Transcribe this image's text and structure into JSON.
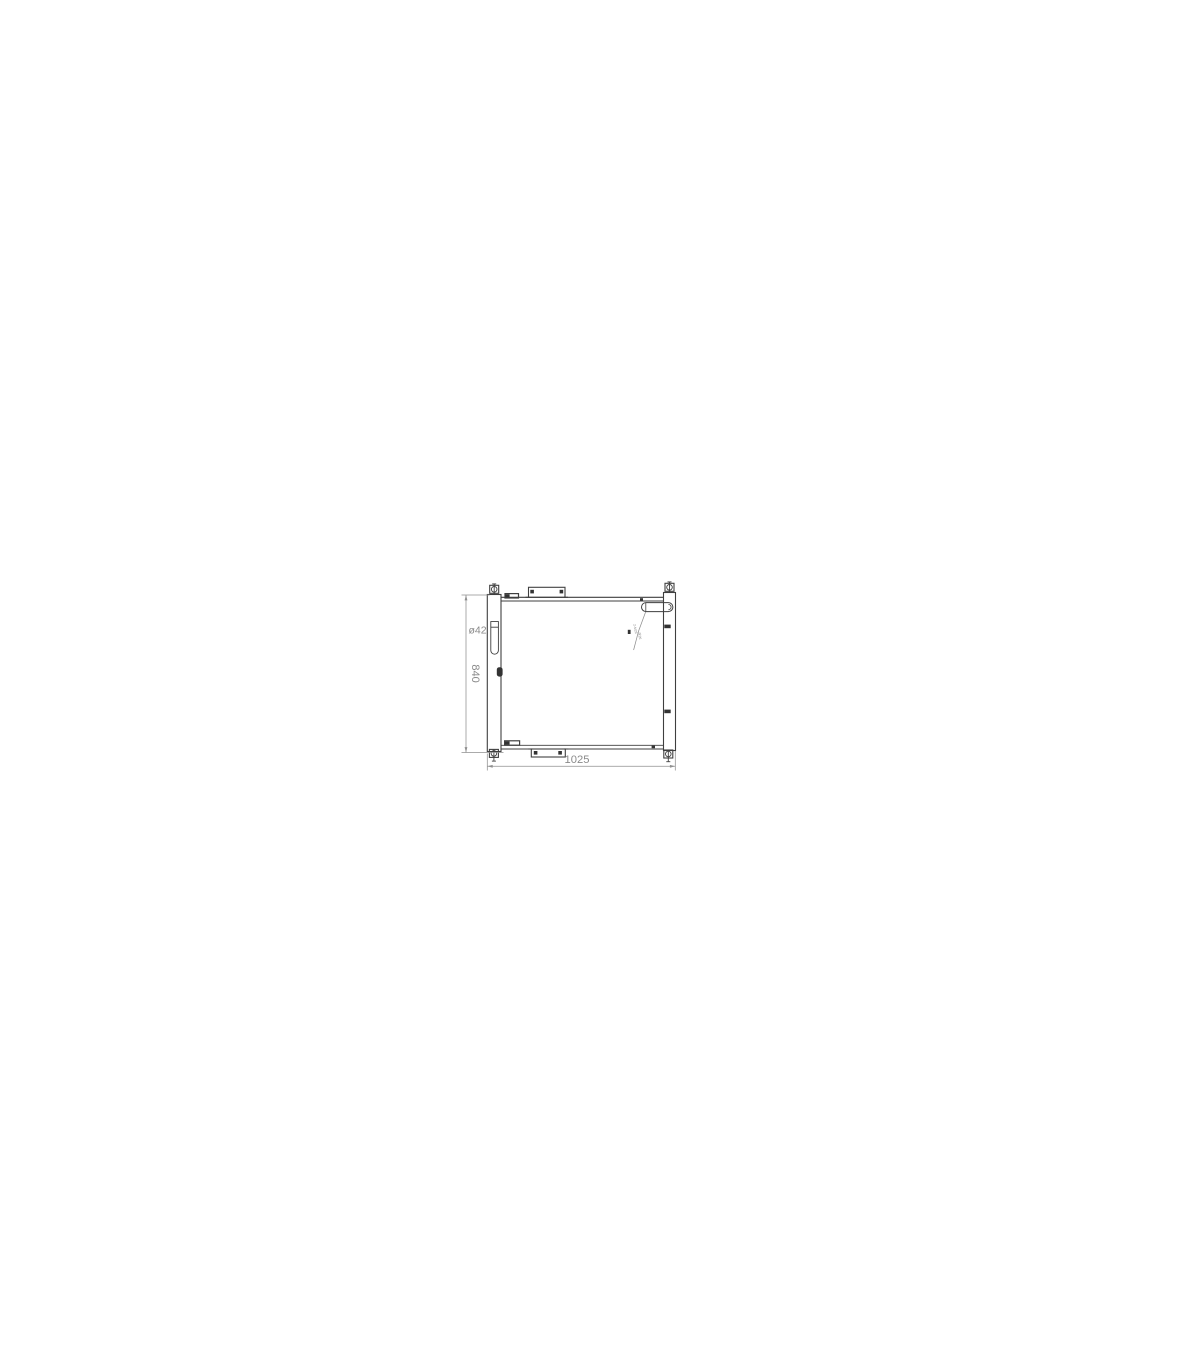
{
  "page": {
    "background": "#ffffff"
  },
  "drawing": {
    "subject": "oil-cooler front-view engineering drawing",
    "colors": {
      "outline": "#3f3f3f",
      "dimension_lines": "#8f8f8f",
      "dimension_text": "#8a8a8a"
    },
    "dimensions": {
      "overall_width": {
        "label": "1025"
      },
      "overall_height": {
        "label": "840"
      },
      "port_diameter": {
        "label": "ø42"
      },
      "inlet_annotation": {
        "line1": "2-M26",
        "line2": "深26"
      }
    }
  }
}
